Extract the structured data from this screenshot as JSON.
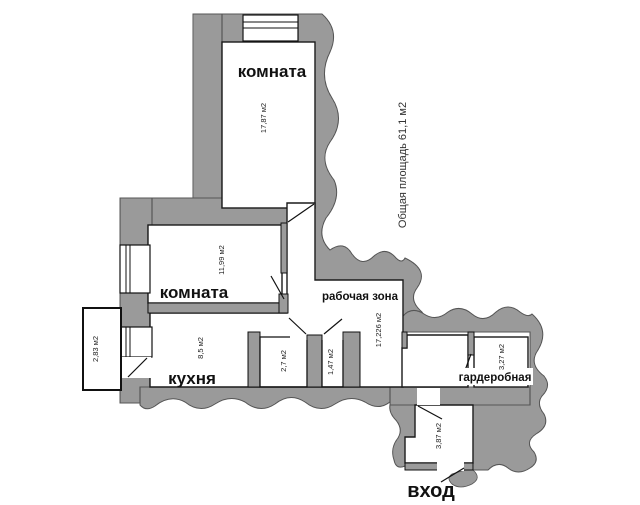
{
  "plan": {
    "total_area_label": "Общая площадь 61,1 м2",
    "entrance_label": "вход",
    "rooms": {
      "room1": {
        "name": "комната",
        "area": "17,87 м2"
      },
      "room2": {
        "name": "комната",
        "area": "11,99 м2"
      },
      "kitchen": {
        "name": "кухня",
        "area": "8,5 м2"
      },
      "work_zone": {
        "name": "рабочая зона",
        "area": "17,226 м2"
      },
      "wardrobe": {
        "name": "гардеробная",
        "area": "3,27 м2"
      },
      "balcony": {
        "area": "2,83 м2"
      },
      "bathroom": {
        "area": "2,7 м2"
      },
      "wc": {
        "area": "1,47 м2"
      },
      "hall": {
        "area": "3,87 м2"
      }
    }
  }
}
